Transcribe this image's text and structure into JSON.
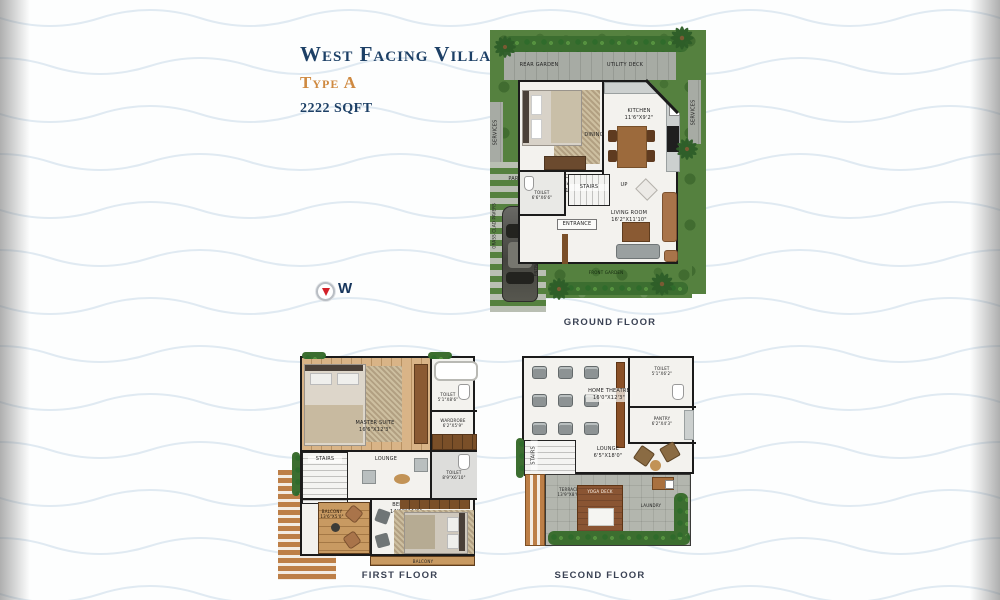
{
  "header": {
    "title": "West Facing Villa",
    "type": "Type A",
    "area": "2222 SQFT"
  },
  "compass": {
    "direction": "W"
  },
  "ground_floor": {
    "caption": "GROUND FLOOR",
    "labels": {
      "rear_garden": "REAR GARDEN",
      "utility_deck": "UTILITY DECK",
      "services_left": "SERVICES",
      "services_right": "SERVICES",
      "grass_pavers": "GRASS CLAD PAVERS",
      "bedroom": "BEDROOM\n(OPTIONAL)\n10'6\"X11'3\"",
      "kitchen": "KITCHEN\n11'6\"X9'2\"",
      "dining": "DINING",
      "toilet": "TOILET\n6'6\"X6'6\"",
      "stairs": "STAIRS",
      "up": "UP",
      "entrance": "ENTRANCE",
      "living_room": "LIVING ROOM\n16'2\"X11'10\"",
      "parking": "PARKING",
      "front_garden": "FRONT GARDEN",
      "entrance_side": "ENTRANCE"
    }
  },
  "first_floor": {
    "caption": "FIRST FLOOR",
    "labels": {
      "master_suite": "MASTER SUITE\n16'6\"X12'3\"",
      "toilet_top": "TOILET\n5'1\"X8'6\"",
      "wardrobe": "WARDROBE\n6'2\"X5'9\"",
      "stairs": "STAIRS",
      "lounge": "LOUNGE",
      "toilet_bottom": "TOILET\n8'9\"X6'10\"",
      "bedroom": "BEDROOM\n14'9\"X11'0\"",
      "balcony": "BALCONY\n13'6\"X5'0\"",
      "balcony_small": "BALCONY"
    }
  },
  "second_floor": {
    "caption": "SECOND FLOOR",
    "labels": {
      "home_theatre": "HOME THEATRE\n16'0\"X12'3\"",
      "toilet": "TOILET\n5'1\"X6'2\"",
      "pantry": "PANTRY\n6'2\"X4'3\"",
      "stairs": "STAIRS",
      "lounge": "LOUNGE\n6'5\"X18'0\"",
      "terrace": "TERRACE\n13'9\"X8'9\"",
      "yoga_deck": "YOGA DECK",
      "laundry": "LAUNDRY"
    }
  }
}
